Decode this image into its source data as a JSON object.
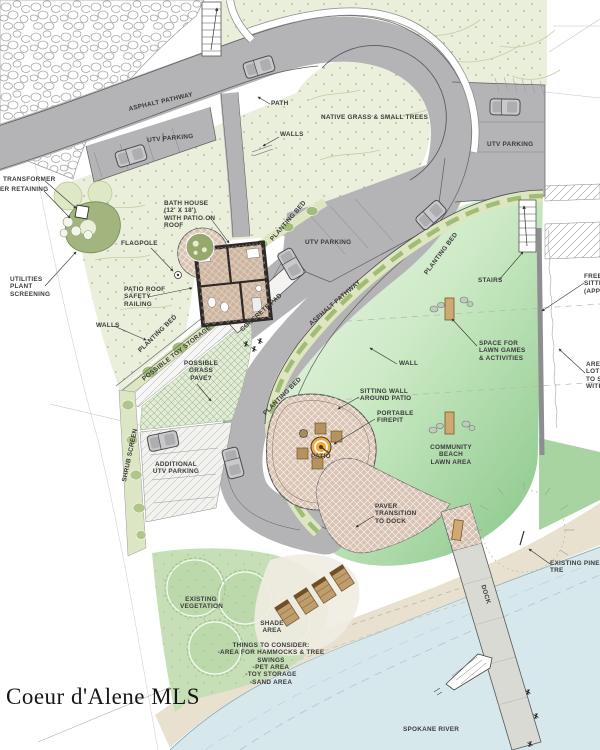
{
  "watermark": "Coeur d'Alene MLS",
  "palette": {
    "road_gray": "#b4b3b5",
    "native_grass": "#e9efdb",
    "lawn_green_deep": "#86c687",
    "planting_bed_light": "#dde6c0",
    "planting_bed_accent": "#a2bd78",
    "patio_paver": "#dbc5b5",
    "firepit_orange": "#f4a73d",
    "bathhouse_wall": "#2e2927",
    "sand": "#e8e1cf",
    "water": "#d7e8ed",
    "dock_gray": "#dadad4",
    "vegetation_green": "#c6dfb6",
    "label_text": "#3b3b3b"
  },
  "labels": {
    "asphalt_pathway_top": "ASPHALT PATHWAY",
    "path": "PATH",
    "native_grass": "NATIVE GRASS & SMALL TREES",
    "utv_parking_top": "UTV PARKING",
    "utv_parking_right": "UTV PARKING",
    "utv_parking_mid": "UTV PARKING",
    "walls_top": "WALLS",
    "transformer": "TRANSFORMER",
    "retaining": "ER RETAINING",
    "bath_house": "BATH HOUSE\n(12' X 18')\nWITH PATIO ON\nROOF",
    "flagpole": "FLAGPOLE",
    "utilities": "UTILITIES\nPLANT\nSCREENING",
    "patio_roof": "PATIO ROOF\nSAFETY\nRAILING",
    "walls_left": "WALLS",
    "planting_bed_left": "PLANTING BED",
    "possible_toy_storage": "POSSIBLE TOY STORAGE",
    "possible_grass_pave": "POSSIBLE\nGRASS\nPAVE?",
    "concrete_pad": "CONCRETE PAD",
    "planting_bed_bathhouse": "PLANTING BED",
    "asphalt_pathway_mid": "ASPHALT PATHWAY",
    "planting_bed_lawn": "PLANTING BED",
    "planting_bed_road": "PLANTING BED",
    "wall": "WALL",
    "sitting_wall": "SITTING WALL\nAROUND PATIO",
    "portable_firepit": "PORTABLE\nFIREPIT",
    "patio": "PATIO",
    "community_beach": "COMMUNITY BEACH\nLAWN AREA",
    "stairs": "STAIRS",
    "space_lawn_games": "SPACE FOR\nLAWN GAMES\n& ACTIVITIES",
    "free_sitting_cut": "FREE\nSITTI\n(APP",
    "area_lot_cut": "ARE\nLOT\nTO S\nWITH",
    "shrub_screen": "SHRUB SCREEN",
    "additional_utv": "ADDITIONAL\nUTV PARKING",
    "paver_transition": "PAVER\nTRANSITION\nTO DOCK",
    "existing_vegetation": "EXISTING\nVEGETATION",
    "shade_area": "SHADE\nAREA",
    "things_to_consider": "THINGS TO CONSIDER:\n-AREA FOR HAMMOCKS & TREE SWINGS\n-PET AREA\n-TOY STORAGE\n-SAND AREA",
    "existing_pine": "EXISTING PINE TRE",
    "dock": "DOCK",
    "spokane_river": "SPOKANE RIVER"
  }
}
